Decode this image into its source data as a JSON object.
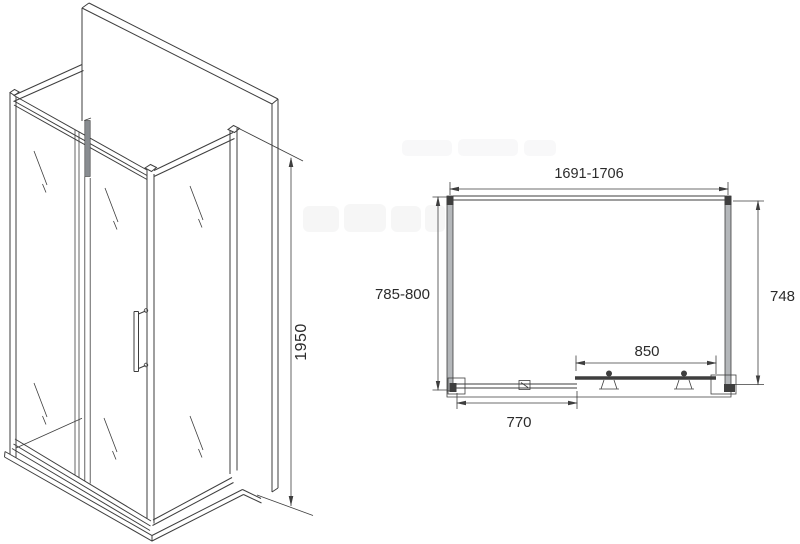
{
  "figure_type": "shower-enclosure-technical-drawing",
  "dimensions": {
    "height": "1950",
    "width_range": "1691-1706",
    "depth_range": "785-800",
    "side_panel_depth": "748",
    "door_opening_width": "850",
    "fixed_panel_width": "770"
  },
  "colors": {
    "line": "#3e3e3e",
    "dim_text": "#2b2b2b",
    "profile_gray": "#b4b7ba",
    "glass_edge_gray": "#888c90",
    "background": "#ffffff"
  }
}
